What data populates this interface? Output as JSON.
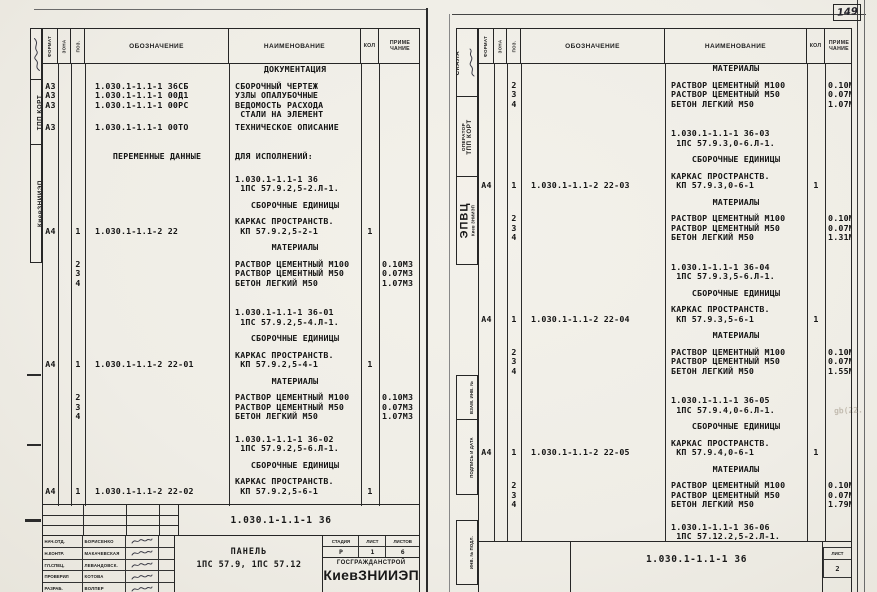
{
  "page_label": "149",
  "header_cols": {
    "format": "ФОРМАТ",
    "zone": "ЗОНА",
    "pos": "ПОЗ.",
    "designation": "ОБОЗНАЧЕНИЕ",
    "name": "НАИМЕНОВАНИЕ",
    "qty": "КОЛ",
    "note1": "ПРИМЕ",
    "note2": "ЧАНИЕ"
  },
  "left_strip": {
    "org": "КиевЗНИИЭП",
    "dept": "ТПП КОРТ"
  },
  "right_strip": {
    "system": "СКАЛА",
    "operator": "ОПЕРАТОР",
    "dept": "ТПП КОРТ",
    "center": "ЭПВЦ",
    "center_sub": "Киев ЗНИИЭП",
    "stamp_vzam": "ВЗАМ. ИНВ. №",
    "stamp_podp": "ПОДПИСЬ И ДАТА",
    "stamp_inv": "ИНВ. № ПОДЛ."
  },
  "left_page": {
    "lines": [
      {
        "n": "ДОКУМЕНТАЦИЯ",
        "cls": "sec"
      },
      {
        "f": "А3",
        "d": "1.030.1-1.1-1 36СБ",
        "n": "СБОРОЧНЫЙ ЧЕРТЕЖ",
        "cls": "m1"
      },
      {
        "f": "А3",
        "d": "1.030.1-1.1-1 00Д1",
        "n": "УЗЛЫ ОПАЛУБОЧНЫЕ"
      },
      {
        "f": "А3",
        "d": "1.030.1-1.1-1 00РС",
        "n": "ВЕДОМОСТЬ РАСХОДА"
      },
      {
        "n": " СТАЛИ НА ЭЛЕМЕНТ"
      },
      {
        "f": "А3",
        "d": "1.030.1-1.1-1 00ТО",
        "n": "ТЕХНИЧЕСКОЕ ОПИСАНИЕ",
        "cls": "mh"
      },
      {
        "d": "ПЕРЕМЕННЫЕ ДАННЫЕ",
        "n": "ДЛЯ ИСПОЛНЕНИЙ:",
        "cls": "var m3"
      },
      {
        "n": "1.030.1-1.1-1 36",
        "cls": "m2"
      },
      {
        "n": " 1ПС 57.9.2,5-2.Л-1."
      },
      {
        "n": "СБОРОЧНЫЕ ЕДИНИЦЫ",
        "cls": "sec m1"
      },
      {
        "n": "КАРКАС ПРОСТРАНСТВ.",
        "cls": "m1"
      },
      {
        "f": "А4",
        "p": "1",
        "d": "1.030.1-1.1-2 22",
        "n": " КП 57.9.2,5-2-1",
        "q": "1"
      },
      {
        "n": "МАТЕРИАЛЫ",
        "cls": "sec m1"
      },
      {
        "p": "2",
        "n": "РАСТВОР ЦЕМЕНТНЫЙ М100",
        "r": "0.10М3",
        "cls": "m1"
      },
      {
        "p": "3",
        "n": "РАСТВОР ЦЕМЕНТНЫЙ М50",
        "r": "0.07М3"
      },
      {
        "p": "4",
        "n": "БЕТОН ЛЕГКИЙ М50",
        "r": "1.07М3"
      },
      {
        "n": "1.030.1-1.1-1 36-01",
        "cls": "m3"
      },
      {
        "n": " 1ПС 57.9.2,5-4.Л-1."
      },
      {
        "n": "СБОРОЧНЫЕ ЕДИНИЦЫ",
        "cls": "sec m1"
      },
      {
        "n": "КАРКАС ПРОСТРАНСТВ.",
        "cls": "m1"
      },
      {
        "f": "А4",
        "p": "1",
        "d": "1.030.1-1.1-2 22-01",
        "n": " КП 57.9.2,5-4-1",
        "q": "1"
      },
      {
        "n": "МАТЕРИАЛЫ",
        "cls": "sec m1"
      },
      {
        "p": "2",
        "n": "РАСТВОР ЦЕМЕНТНЫЙ М100",
        "r": "0.10М3",
        "cls": "m1"
      },
      {
        "p": "3",
        "n": "РАСТВОР ЦЕМЕНТНЫЙ М50",
        "r": "0.07М3"
      },
      {
        "p": "4",
        "n": "БЕТОН ЛЕГКИЙ М50",
        "r": "1.07М3"
      },
      {
        "n": "1.030.1-1.1-1 36-02",
        "cls": "m2"
      },
      {
        "n": " 1ПС 57.9.2,5-6.Л-1."
      },
      {
        "n": "СБОРОЧНЫЕ ЕДИНИЦЫ",
        "cls": "sec m1"
      },
      {
        "n": "КАРКАС ПРОСТРАНСТВ.",
        "cls": "m1"
      },
      {
        "f": "А4",
        "p": "1",
        "d": "1.030.1-1.1-2 22-02",
        "n": " КП 57.9.2,5-6-1",
        "q": "1"
      }
    ],
    "footer": {
      "designation": "1.030.1-1.1-1 36",
      "sign_rows": [
        {
          "role": "НАЧ.ОТД.",
          "name": "БОРИСЕНКО"
        },
        {
          "role": "Н.КОНТР.",
          "name": "МАКАЧЕВСКАЯ"
        },
        {
          "role": "ГЛ.СПЕЦ.",
          "name": "ЛЕВАНДОВСК."
        },
        {
          "role": "ПРОВЕРИЛ",
          "name": "КОТОВА"
        },
        {
          "role": "РАЗРАБ.",
          "name": "ВОЛПЕР"
        }
      ],
      "title_line1": "ПАНЕЛЬ",
      "title_line2": "1ПС 57.9, 1ПС 57.12",
      "stage_label": "СТАДИЯ",
      "sheet_label": "ЛИСТ",
      "sheets_label": "ЛИСТОВ",
      "stage": "Р",
      "sheet": "1",
      "sheets": "6",
      "org1": "ГОСГРАЖДАНСТРОЙ",
      "org2": "КиевЗНИИЭП"
    }
  },
  "right_page": {
    "lines": [
      {
        "n": "МАТЕРИАЛЫ",
        "cls": "sec"
      },
      {
        "p": "2",
        "n": "РАСТВОР ЦЕМЕНТНЫЙ М100",
        "r": "0.10М3",
        "cls": "m1"
      },
      {
        "p": "3",
        "n": "РАСТВОР ЦЕМЕНТНЫЙ М50",
        "r": "0.07М3"
      },
      {
        "p": "4",
        "n": "БЕТОН ЛЕГКИЙ М50",
        "r": "1.07М3"
      },
      {
        "n": "1.030.1-1.1-1 36-03",
        "cls": "m3"
      },
      {
        "n": " 1ПС 57.9.3,0-6.Л-1."
      },
      {
        "n": "СБОРОЧНЫЕ ЕДИНИЦЫ",
        "cls": "sec m1"
      },
      {
        "n": "КАРКАС ПРОСТРАНСТВ.",
        "cls": "m1"
      },
      {
        "f": "А4",
        "p": "1",
        "d": "1.030.1-1.1-2 22-03",
        "n": " КП 57.9.3,0-6-1",
        "q": "1"
      },
      {
        "n": "МАТЕРИАЛЫ",
        "cls": "sec m1"
      },
      {
        "p": "2",
        "n": "РАСТВОР ЦЕМЕНТНЫЙ М100",
        "r": "0.10М3",
        "cls": "m1"
      },
      {
        "p": "3",
        "n": "РАСТВОР ЦЕМЕНТНЫЙ М50",
        "r": "0.07М3"
      },
      {
        "p": "4",
        "n": "БЕТОН ЛЕГКИЙ М50",
        "r": "1.31М3"
      },
      {
        "n": "1.030.1-1.1-1 36-04",
        "cls": "m3"
      },
      {
        "n": " 1ПС 57.9.3,5-6.Л-1."
      },
      {
        "n": "СБОРОЧНЫЕ ЕДИНИЦЫ",
        "cls": "sec m1"
      },
      {
        "n": "КАРКАС ПРОСТРАНСТВ.",
        "cls": "m1"
      },
      {
        "f": "А4",
        "p": "1",
        "d": "1.030.1-1.1-2 22-04",
        "n": " КП 57.9.3,5-6-1",
        "q": "1"
      },
      {
        "n": "МАТЕРИАЛЫ",
        "cls": "sec m1"
      },
      {
        "p": "2",
        "n": "РАСТВОР ЦЕМЕНТНЫЙ М100",
        "r": "0.10М3",
        "cls": "m1"
      },
      {
        "p": "3",
        "n": "РАСТВОР ЦЕМЕНТНЫЙ М50",
        "r": "0.07М3"
      },
      {
        "p": "4",
        "n": "БЕТОН ЛЕГКИЙ М50",
        "r": "1.55М3"
      },
      {
        "n": "1.030.1-1.1-1 36-05",
        "cls": "m3"
      },
      {
        "n": " 1ПС 57.9.4,0-6.Л-1."
      },
      {
        "n": "СБОРОЧНЫЕ ЕДИНИЦЫ",
        "cls": "sec m1"
      },
      {
        "n": "КАРКАС ПРОСТРАНСТВ.",
        "cls": "m1"
      },
      {
        "f": "А4",
        "p": "1",
        "d": "1.030.1-1.1-2 22-05",
        "n": " КП 57.9.4,0-6-1",
        "q": "1"
      },
      {
        "n": "МАТЕРИАЛЫ",
        "cls": "sec m1"
      },
      {
        "p": "2",
        "n": "РАСТВОР ЦЕМЕНТНЫЙ М100",
        "r": "0.10М3",
        "cls": "m1"
      },
      {
        "p": "3",
        "n": "РАСТВОР ЦЕМЕНТНЫЙ М50",
        "r": "0.07М3"
      },
      {
        "p": "4",
        "n": "БЕТОН ЛЕГКИЙ М50",
        "r": "1.79М3"
      },
      {
        "n": "1.030.1-1.1-1 36-06",
        "cls": "m2"
      },
      {
        "n": " 1ПС 57.12.2,5-2.Л-1."
      }
    ],
    "footer": {
      "designation": "1.030.1-1.1-1 36",
      "sheet_label": "ЛИСТ",
      "sheet": "2"
    },
    "artifact": "gb(22."
  }
}
